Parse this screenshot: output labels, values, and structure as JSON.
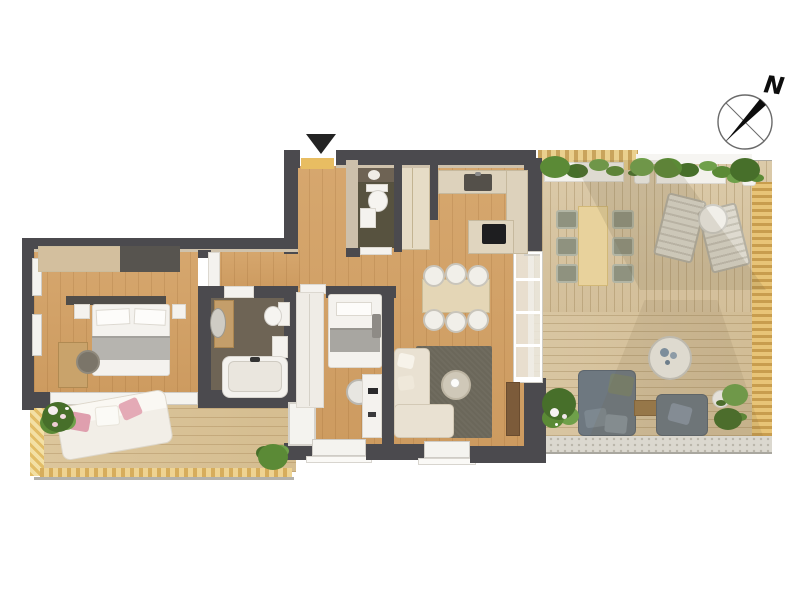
{
  "compass": {
    "label": "N"
  },
  "icons": {
    "compass": "compass-rose-icon",
    "entrance": "entrance-arrow-icon"
  },
  "palette": {
    "background": "#ffffff",
    "wall_dark": "#4b4a4e",
    "wall_beige": "#cdc0ab",
    "window_white": "#f4f3ef",
    "floor_wood": "#d2a268",
    "floor_dark_bath": "#6e6455",
    "floor_dark_wc": "#57523f",
    "terrace_deck": "#d9c8a6",
    "balcony_deck": "#d8c298",
    "rug_olive": "#6b675a",
    "sofa_cream": "#e9e1d2",
    "outdoor_gray": "#6e7880",
    "plant_green": "#5b8a36",
    "accent_pink": "#df9fae",
    "awning_tan": "#e2bd67",
    "counter_beige": "#ddd2bc",
    "cooktop_black": "#1e1e20"
  }
}
